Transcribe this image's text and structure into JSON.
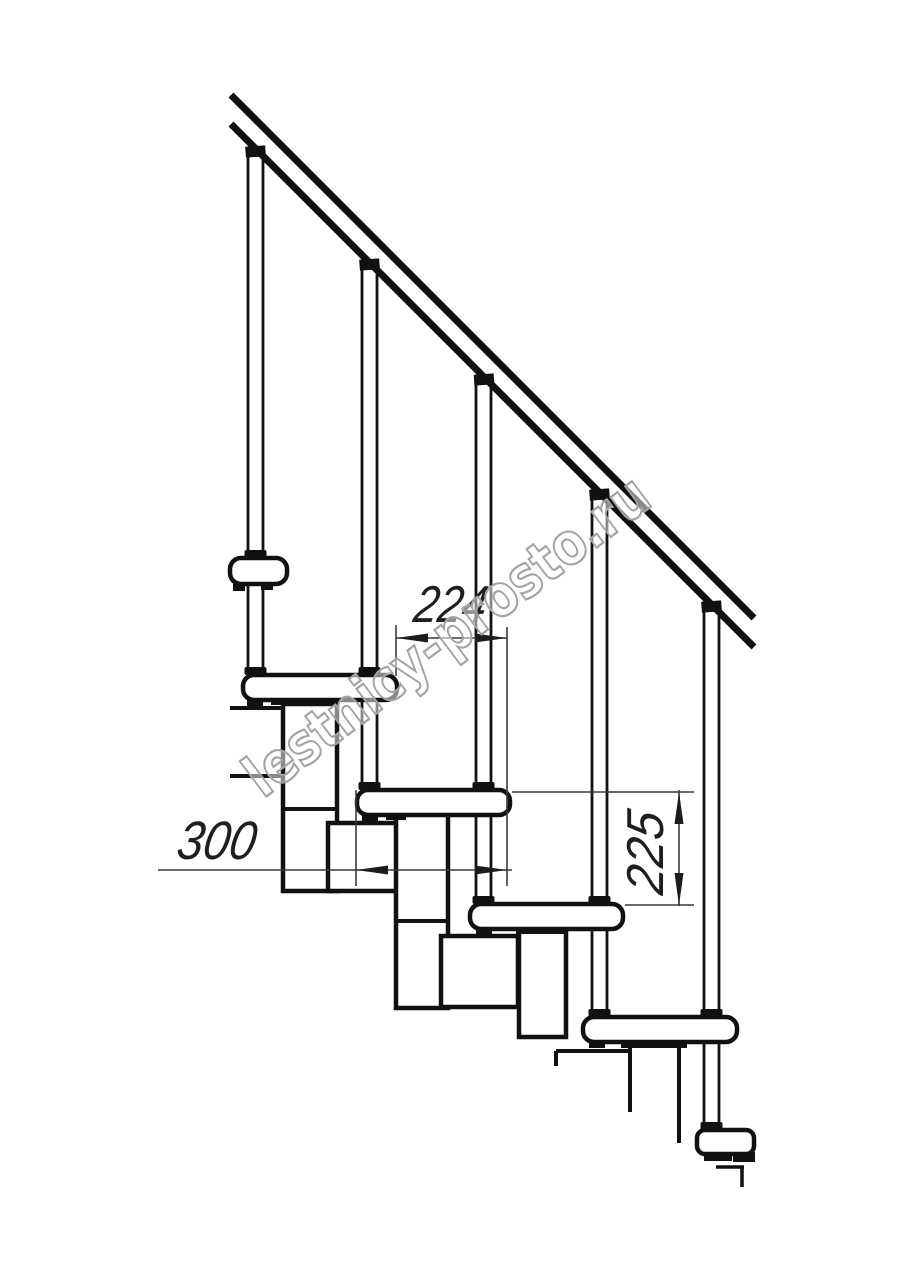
{
  "drawing": {
    "title": "Modular staircase side-view technical drawing",
    "labels": {
      "dim_spacing": "224",
      "dim_depth": "300",
      "dim_riser": "225"
    },
    "dimensions": [
      {
        "value": 224,
        "unit": "mm",
        "orientation": "horizontal",
        "meaning": "horizontal distance between step noses"
      },
      {
        "value": 300,
        "unit": "mm",
        "orientation": "horizontal",
        "meaning": "tread depth"
      },
      {
        "value": 225,
        "unit": "mm",
        "orientation": "vertical",
        "meaning": "riser height between tread tops"
      }
    ],
    "watermark": "lestnicy-prosto.ru",
    "counts": {
      "balusters": 5,
      "treads": 4,
      "handrail_lines": 2
    },
    "colors": {
      "background": "#ffffff",
      "drawing_line": "#111111",
      "dimension_line": "#3a3a3a",
      "watermark_outline": "#a3a3a3"
    }
  }
}
